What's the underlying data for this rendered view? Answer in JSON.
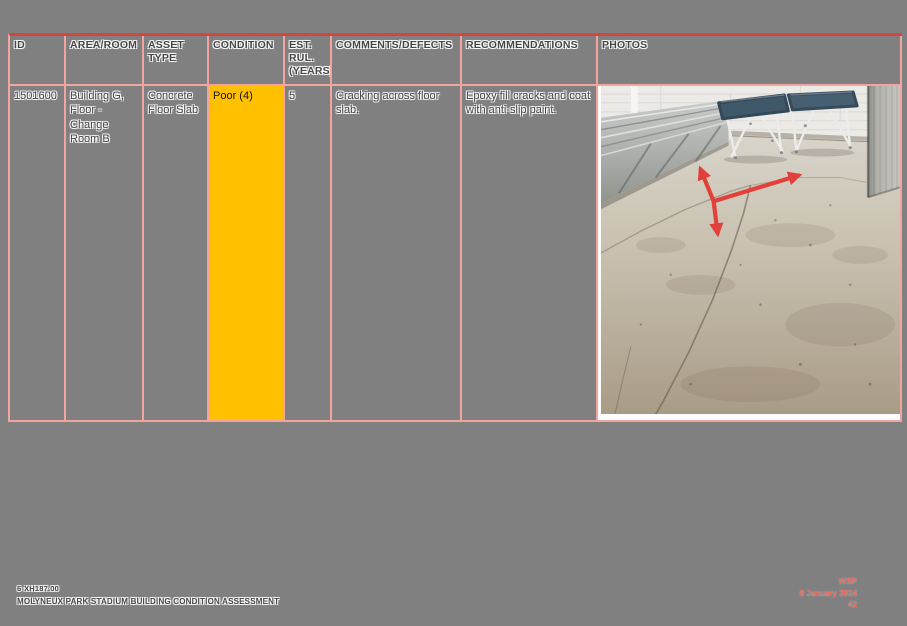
{
  "table": {
    "columns": [
      {
        "label": "ID"
      },
      {
        "label": "AREA/ROOM"
      },
      {
        "label": "ASSET TYPE"
      },
      {
        "label": "CONDITION"
      },
      {
        "label": "EST. RUL. (YEARS)"
      },
      {
        "label": "COMMENTS/DEFECTS"
      },
      {
        "label": "RECOMMENDATIONS"
      },
      {
        "label": "PHOTOS"
      }
    ],
    "row": {
      "id": "1501600",
      "area_room": "Building G, Floor - Change Room B",
      "asset_type": "Concrete Floor Slab",
      "condition": "Poor (4)",
      "est_rul_years": "5",
      "comments_defects": "Cracking across floor slab.",
      "recommendations": "Epoxy fill cracks and coat with anti-slip paint."
    }
  },
  "photo": {
    "alt": "Change room interior: cracked concrete floor slab marked with red arrows, wall-mounted slat bench on left, two blue folding tables against white brick wall, grey partition panel on right"
  },
  "footer": {
    "left": {
      "project_number": "6-XH187.00",
      "document_title": "MOLYNEUX PARK STADIUM BUILDING CONDITION ASSESSMENT"
    },
    "right": {
      "company": "WSP",
      "date": "8 January 2024",
      "page_number": "42"
    }
  },
  "colors": {
    "page_background": "#808080",
    "table_border": "#F2A49E",
    "table_border_top": "#D6453B",
    "condition_poor_fill": "#FFC000",
    "annotation_arrow": "#E2403A",
    "footer_accent": "#E5695F"
  }
}
